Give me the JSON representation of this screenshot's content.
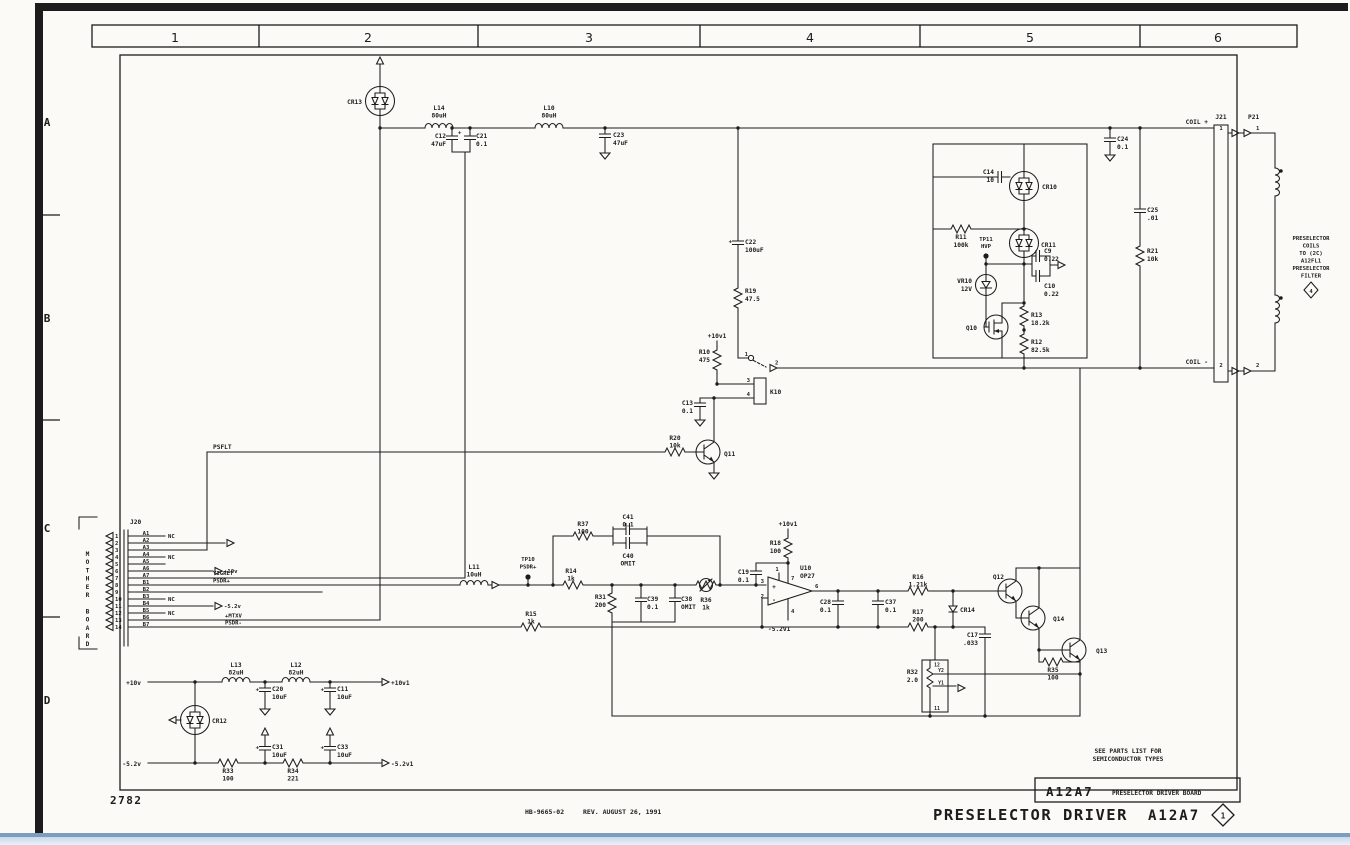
{
  "frame": {
    "cols": [
      "1",
      "2",
      "3",
      "4",
      "5",
      "6"
    ],
    "rows": [
      "A",
      "B",
      "C",
      "D"
    ]
  },
  "marks": {
    "plus": "+",
    "minus": "-"
  },
  "nets": {
    "psflt": "PSFLT",
    "yigret": "YIGRET",
    "psdrp": "PSDR+",
    "mtxv": "+MTXV",
    "psdrm": "PSDR-",
    "coilp": "COIL +",
    "coilm": "COIL -",
    "p10": "+10v",
    "p10i": "+10v1",
    "m52": "-5.2v",
    "m52i": "-5.2v1"
  },
  "j20": {
    "r": "J20",
    "board": "MOTHER BOARD",
    "pins": [
      {
        "n": "1",
        "s": "A1",
        "t": "NC"
      },
      {
        "n": "2",
        "s": "A2"
      },
      {
        "n": "3",
        "s": "A3"
      },
      {
        "n": "4",
        "s": "A4",
        "t": "NC"
      },
      {
        "n": "5",
        "s": "A5"
      },
      {
        "n": "6",
        "s": "A6",
        "t": "+10v"
      },
      {
        "n": "7",
        "s": "A7"
      },
      {
        "n": "8",
        "s": "B1"
      },
      {
        "n": "9",
        "s": "B2"
      },
      {
        "n": "10",
        "s": "B3",
        "t": "NC"
      },
      {
        "n": "11",
        "s": "B4",
        "t": "-5.2v"
      },
      {
        "n": "12",
        "s": "B5",
        "t": "NC"
      },
      {
        "n": "13",
        "s": "B6"
      },
      {
        "n": "14",
        "s": "B7"
      }
    ]
  },
  "j21": {
    "r": "J21",
    "p1": "1",
    "p2": "2"
  },
  "p21": {
    "r": "P21",
    "p1": "1",
    "p2": "2"
  },
  "k10": {
    "r": "K10",
    "p1": "1",
    "p2": "2",
    "p3": "3",
    "p4": "4"
  },
  "u10": {
    "r": "U10",
    "v": "OP27",
    "p1": "1",
    "p2": "2",
    "p3": "3",
    "p4": "4",
    "p6": "6",
    "p7": "7"
  },
  "parts": {
    "cr13": {
      "r": "CR13"
    },
    "l14": {
      "r": "L14",
      "v": "80uH"
    },
    "l10": {
      "r": "L10",
      "v": "80uH"
    },
    "c12": {
      "r": "C12",
      "v": "47uF"
    },
    "c21": {
      "r": "C21",
      "v": "0.1"
    },
    "c23": {
      "r": "C23",
      "v": "47uF"
    },
    "c24": {
      "r": "C24",
      "v": "0.1"
    },
    "c25": {
      "r": "C25",
      "v": ".01"
    },
    "r21": {
      "r": "R21",
      "v": "10k"
    },
    "c22": {
      "r": "C22",
      "v": "100uF"
    },
    "r19": {
      "r": "R19",
      "v": "47.5"
    },
    "c14": {
      "r": "C14",
      "v": "10"
    },
    "cr10": {
      "r": "CR10"
    },
    "r11": {
      "r": "R11",
      "v": "100k"
    },
    "tp11": {
      "r": "TP11",
      "v": "HVP"
    },
    "cr11": {
      "r": "CR11"
    },
    "c9": {
      "r": "C9",
      "v": "0.22"
    },
    "vr10": {
      "r": "VR10",
      "v": "12V"
    },
    "c10": {
      "r": "C10",
      "v": "0.22"
    },
    "q10": {
      "r": "Q10"
    },
    "r13": {
      "r": "R13",
      "v": "18.2k"
    },
    "r12": {
      "r": "R12",
      "v": "82.5k"
    },
    "r10": {
      "r": "R10",
      "v": "475"
    },
    "c13": {
      "r": "C13",
      "v": "0.1"
    },
    "r20": {
      "r": "R20",
      "v": "10k"
    },
    "q11": {
      "r": "Q11"
    },
    "l11": {
      "r": "L11",
      "v": "10uH"
    },
    "tp10": {
      "r": "TP10",
      "v": "PSDR+"
    },
    "r37": {
      "r": "R37",
      "v": "100"
    },
    "c41": {
      "r": "C41",
      "v": "0.1"
    },
    "c40": {
      "r": "C40",
      "v": "OMIT"
    },
    "r14": {
      "r": "R14",
      "v": "1k"
    },
    "r31": {
      "r": "R31",
      "v": "200"
    },
    "c39": {
      "r": "C39",
      "v": "0.1"
    },
    "c38": {
      "r": "C38",
      "v": "OMIT"
    },
    "r36": {
      "r": "R36",
      "v": "1k"
    },
    "c19": {
      "r": "C19",
      "v": "0.1"
    },
    "r18": {
      "r": "R18",
      "v": "100"
    },
    "c28": {
      "r": "C28",
      "v": "0.1"
    },
    "c37": {
      "r": "C37",
      "v": "0.1"
    },
    "r16": {
      "r": "R16",
      "v": "1.21k"
    },
    "r17": {
      "r": "R17",
      "v": "200"
    },
    "cr14": {
      "r": "CR14"
    },
    "c17": {
      "r": "C17",
      "v": ".033"
    },
    "q12": {
      "r": "Q12"
    },
    "q14": {
      "r": "Q14"
    },
    "q13": {
      "r": "Q13"
    },
    "r35": {
      "r": "R35",
      "v": "100"
    },
    "r15": {
      "r": "R15",
      "v": "1k"
    },
    "r32": {
      "r": "R32",
      "v": "2.0",
      "t": "Y2",
      "b": "Y1",
      "pt": "12",
      "pb": "11"
    },
    "l13": {
      "r": "L13",
      "v": "82uH"
    },
    "l12": {
      "r": "L12",
      "v": "82uH"
    },
    "c20": {
      "r": "C20",
      "v": "10uF"
    },
    "c11": {
      "r": "C11",
      "v": "10uF"
    },
    "cr12": {
      "r": "CR12"
    },
    "c31": {
      "r": "C31",
      "v": "10uF"
    },
    "c33": {
      "r": "C33",
      "v": "10uF"
    },
    "r33": {
      "r": "R33",
      "v": "100"
    },
    "r34": {
      "r": "R34",
      "v": "221"
    }
  },
  "coilnote": {
    "l1": "PRESELECTOR",
    "l2": "COILS",
    "l3": "TO (2C)",
    "l4": "A12FL1",
    "l5": "PRESELECTOR",
    "l6": "FILTER",
    "d": "4"
  },
  "tblock": {
    "assy": "A12A7",
    "name": "PRESELECTOR DRIVER BOARD",
    "n1": "SEE PARTS LIST FOR",
    "n2": "SEMICONDUCTOR TYPES"
  },
  "footer": {
    "num": "2782",
    "doc": "HB-9665-02",
    "rev": "REV. AUGUST 26, 1991",
    "title": "PRESELECTOR DRIVER",
    "assy": "A12A7",
    "sheet": "1"
  }
}
